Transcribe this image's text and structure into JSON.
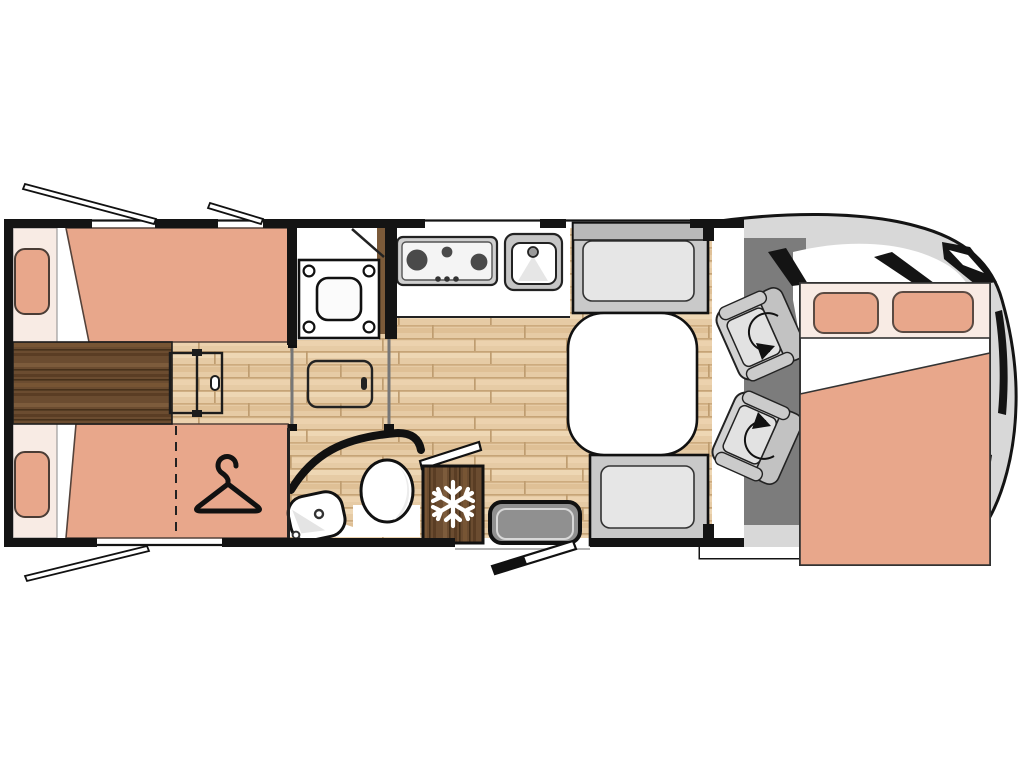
{
  "title": "motorhome-floorplan-diagram",
  "colors": {
    "wall": "#141414",
    "outline": "#1a1a1a",
    "bed_salmon": "#e8a78b",
    "bed_cream": "#f8ebe4",
    "wood_light": "#e6cba5",
    "wood_dark": "#6b4c30",
    "cab_floor": "#7c7c7c",
    "body_gray": "#d8d8d8",
    "seat_gray": "#d2d2d2",
    "seat_back_gray": "#c2c2c2",
    "cushion_light": "#e2e2e2",
    "bench_gray": "#c9c9c9",
    "bench_cushion": "#e6e6e6",
    "step_gray": "#909090",
    "white": "#ffffff",
    "snowflake": "#ffffff"
  },
  "plan": {
    "vehicle_type": "motorhome",
    "areas": [
      {
        "name": "rear-twin-single-beds",
        "items": [
          "bed-upper",
          "bed-lower",
          "pillow-upper",
          "pillow-lower",
          "bedside-chest",
          "fold-out-step"
        ]
      },
      {
        "name": "wardrobe",
        "icon": "clothes-hanger-icon"
      },
      {
        "name": "shower-room",
        "icon": "shower-tray"
      },
      {
        "name": "washroom",
        "items": [
          "toilet",
          "washbasin"
        ]
      },
      {
        "name": "kitchen",
        "items": [
          "hob-3-burners",
          "sink",
          "worktop"
        ]
      },
      {
        "name": "refrigerator",
        "icon": "snowflake-icon"
      },
      {
        "name": "dinette",
        "items": [
          "table",
          "bench-seat-front",
          "bench-seat-rear"
        ]
      },
      {
        "name": "entrance",
        "items": [
          "entry-step",
          "entry-door-open"
        ]
      },
      {
        "name": "cab",
        "items": [
          "swivel-seat-1",
          "swivel-seat-2",
          "rotation-arrow-1",
          "rotation-arrow-2"
        ]
      },
      {
        "name": "overcab-drop-down-double-bed",
        "items": [
          "pillow-left",
          "pillow-right",
          "duvet"
        ]
      }
    ],
    "counts": {
      "hob_burners": 3,
      "cab_swivel_seats": 2,
      "single_beds": 2,
      "double_beds": 1,
      "open_window_flaps": 3,
      "pillows": 4
    }
  }
}
